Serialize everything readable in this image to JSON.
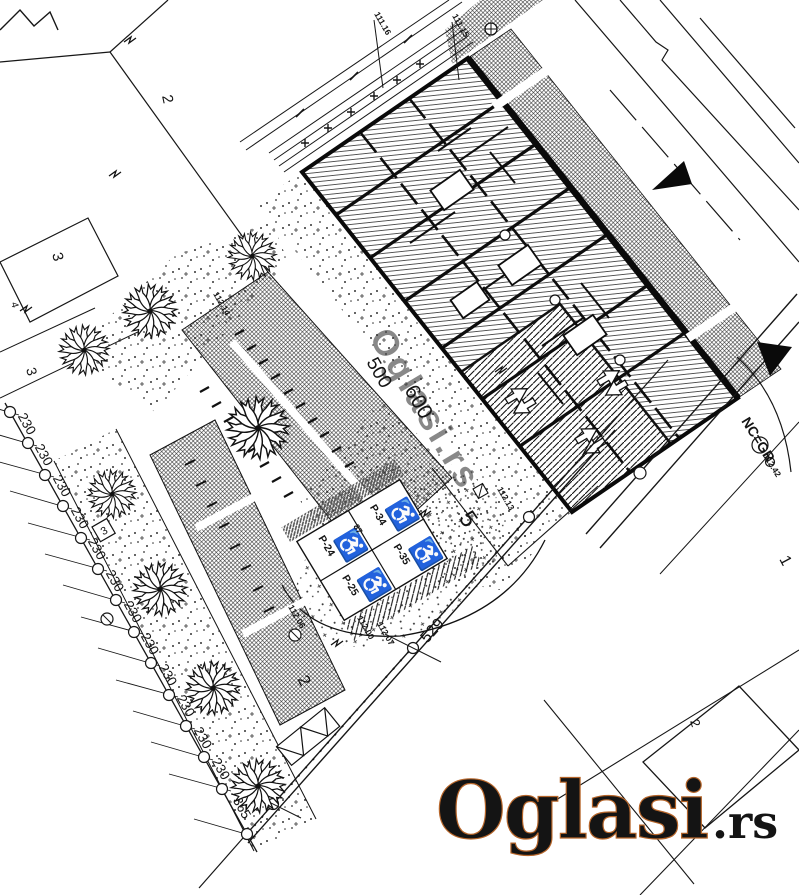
{
  "colors": {
    "ink": "#1a1a1a",
    "wm_orange": "#e8883f",
    "wm_outline": "#b5652a",
    "wm_gray": "#9a9a9a"
  },
  "watermark": {
    "word": "Oglasi",
    "tld": ".rs",
    "ghost": "Oglasi.rs"
  },
  "road": {
    "nc_gr": "NC=GR"
  },
  "dims": {
    "chain": [
      "230",
      "230",
      "230",
      "230",
      "230",
      "230",
      "230",
      "230",
      "230",
      "230",
      "230",
      "230",
      "365"
    ],
    "v500": "500",
    "v600": "600",
    "v529": "529",
    "v87": "87"
  },
  "elev": {
    "e1": "111.16",
    "e2": "111.15",
    "e3": "112.14",
    "e4": "112.13",
    "e5": "112.06",
    "e6": "112.00",
    "e7": "112.07",
    "e8": "112.42"
  },
  "parcels": {
    "top2": "2",
    "left3a": "3",
    "left4": "4",
    "left3b": "3",
    "boxed3": "3",
    "p5": "5",
    "bottom2": "2",
    "right1": "1",
    "se2": "2"
  },
  "parking": {
    "stalls": [
      "P-24",
      "P-25",
      "P-34",
      "P-35"
    ],
    "symbol": "♿"
  }
}
